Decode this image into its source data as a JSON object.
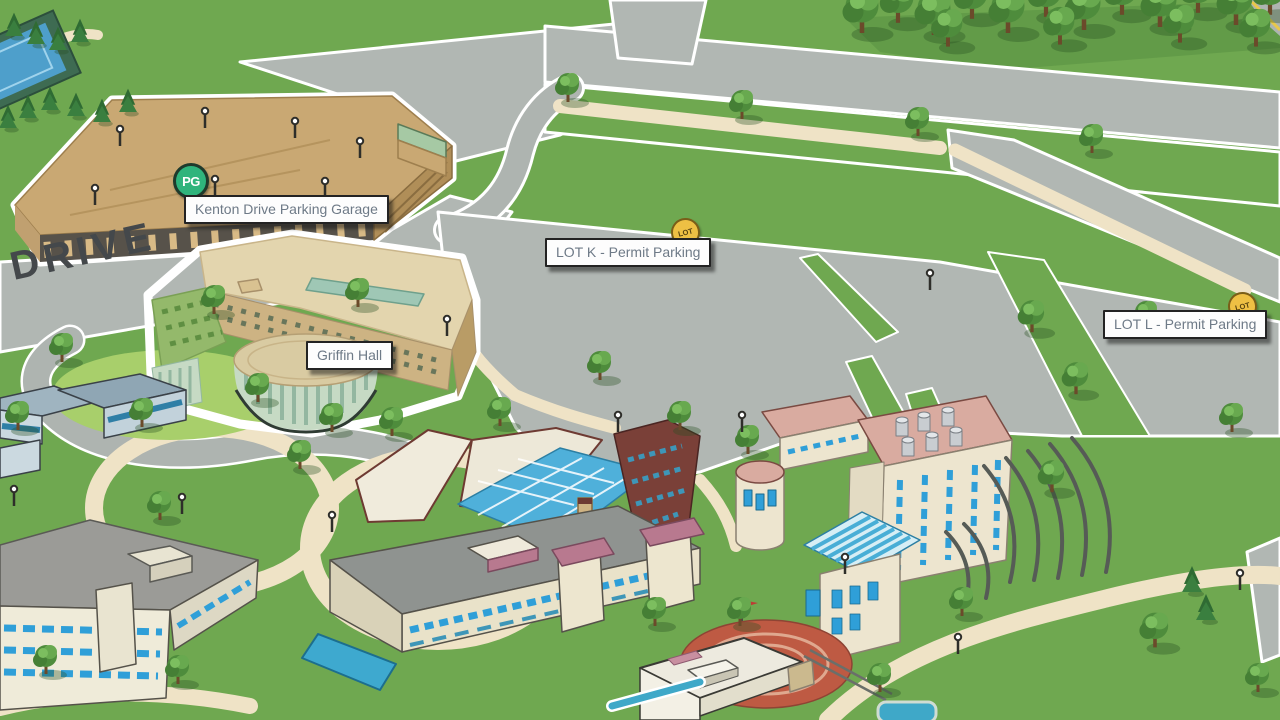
{
  "map": {
    "road_label": "DRIVE",
    "markers": [
      {
        "id": "kenton-garage",
        "badge": "PG",
        "label": "Kenton Drive Parking Garage"
      },
      {
        "id": "griffin-hall",
        "badge": "",
        "label": "Griffin Hall"
      },
      {
        "id": "lot-k",
        "badge": "LOT",
        "label": "LOT K - Permit Parking"
      },
      {
        "id": "lot-l",
        "badge": "LOT",
        "label": "LOT L - Permit Parking"
      }
    ],
    "colors": {
      "grass": "#6FA850",
      "lawn_light": "#A8CF6B",
      "road": "#B1B7B3",
      "path_tan": "#EFE3C6",
      "label_text": "#6E7A87",
      "label_border": "#232323",
      "garage_badge_green": "#2FB47C",
      "lot_badge_yellow": "#EEC044",
      "building_tan": "#C9A873",
      "building_cream": "#EDE5CF",
      "window_blue": "#2F9FD8",
      "roof_pink": "#D9ABA0",
      "maroon_brick": "#7A4038",
      "skylight_teal": "#4FB0DA",
      "plaza_red": "#BE5A43",
      "drive_text": "#44484B"
    }
  }
}
